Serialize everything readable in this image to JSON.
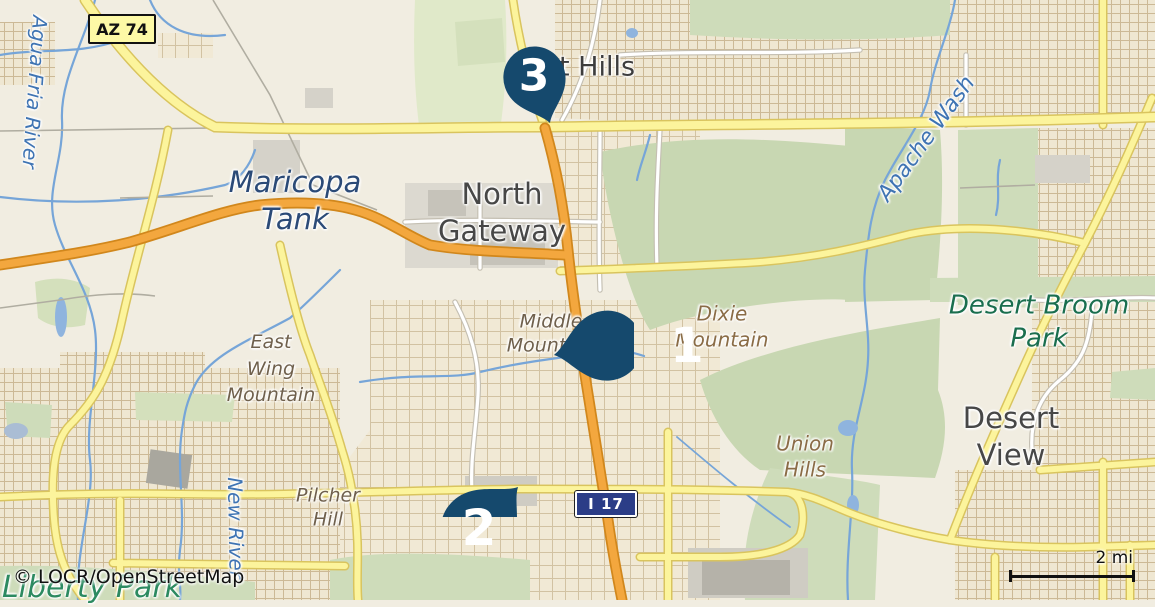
{
  "map": {
    "attribution": "© LOCR/OpenStreetMap",
    "scale_bar": {
      "label": "2 mi"
    },
    "shields": {
      "az74": {
        "label": "AZ 74",
        "bg_color": "#fdf9a6",
        "text_color": "#111111"
      },
      "i17": {
        "label": "I 17",
        "bg_color": "#2b3d87",
        "text_color": "#ffffff"
      }
    },
    "markers": [
      {
        "number": "1"
      },
      {
        "number": "2"
      },
      {
        "number": "3"
      }
    ],
    "labels": {
      "agua_fria_river": {
        "lines": [
          "Agua Fria River"
        ]
      },
      "maricopa_tank": {
        "lines": [
          "Maricopa",
          "Tank"
        ]
      },
      "north_gateway": {
        "lines": [
          "North",
          "Gateway"
        ]
      },
      "desert_hills_partial": {
        "lines": [
          "t Hills"
        ]
      },
      "apache_wash": {
        "lines": [
          "Apache Wash"
        ]
      },
      "desert_broom_park": {
        "lines": [
          "Desert Broom",
          "Park"
        ]
      },
      "middle_mountain": {
        "lines": [
          "Middle",
          "Mountain"
        ]
      },
      "dixie_mountain": {
        "lines": [
          "Dixie",
          "Mountain"
        ]
      },
      "east_wing_mountain": {
        "lines": [
          "East",
          "Wing",
          "Mountain"
        ]
      },
      "union_hills": {
        "lines": [
          "Union",
          "Hills"
        ]
      },
      "desert_view": {
        "lines": [
          "Desert",
          "View"
        ]
      },
      "pilcher_hill": {
        "lines": [
          "Pilcher",
          "Hill"
        ]
      },
      "new_river": {
        "lines": [
          "New River"
        ]
      },
      "liberty_park": {
        "lines": [
          "Liberty Park"
        ]
      }
    },
    "colors": {
      "background": "#f1ede1",
      "green_area": "#cedcba",
      "urban_area": "#f1e9d5",
      "road_major": "#fcf49c",
      "road_trunk": "#f3a73e",
      "water": "#76a5d8",
      "marker_pin": "#15496d"
    }
  }
}
